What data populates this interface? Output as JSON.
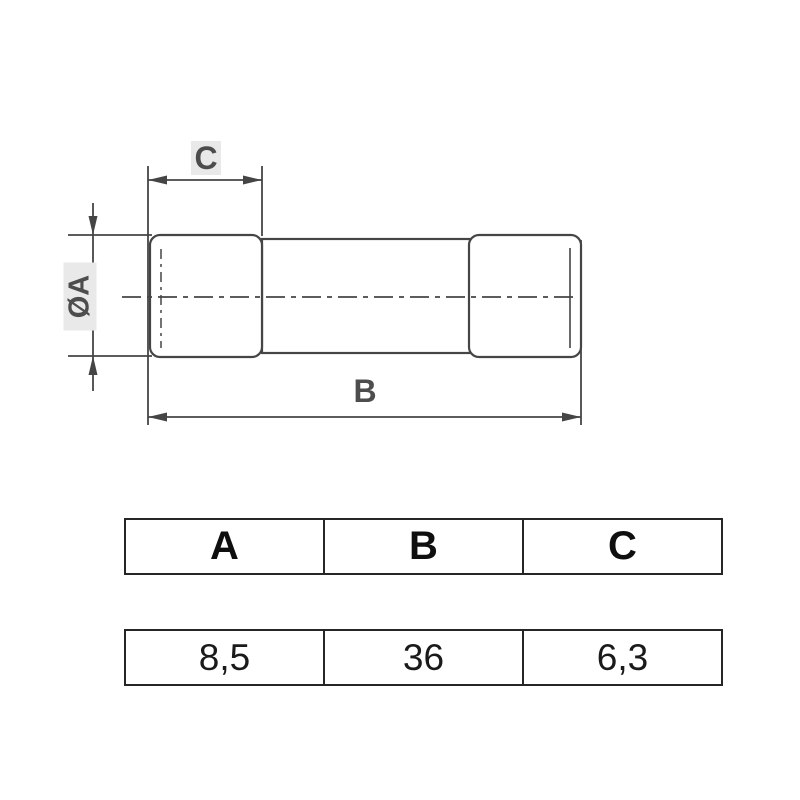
{
  "drawing": {
    "dim_labels": {
      "cap_length": "C",
      "diameter": "ØA",
      "overall_length": "B"
    }
  },
  "table": {
    "headers": [
      "A",
      "B",
      "C"
    ],
    "values": [
      "8,5",
      "36",
      "6,3"
    ]
  },
  "colors": {
    "drawing_line": "#454545",
    "table_border": "#262626",
    "label_background": "#e9e9e9",
    "label_text": "#4d4d4d",
    "table_text": "#1a1a1a"
  }
}
